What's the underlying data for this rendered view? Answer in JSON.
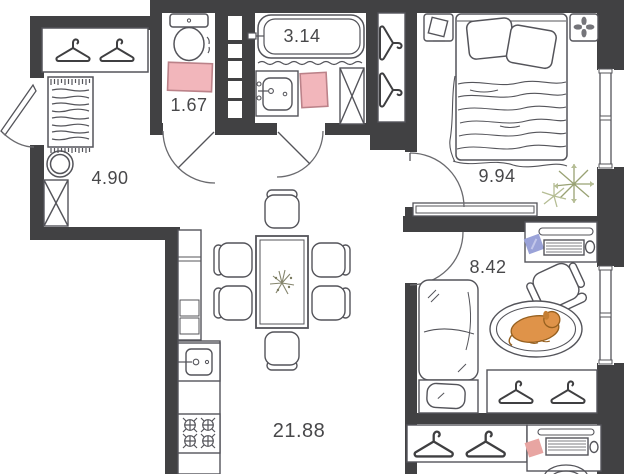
{
  "plan": {
    "title": "apartment-floor-plan",
    "rooms": [
      {
        "id": "hallway",
        "area": "4.90"
      },
      {
        "id": "wc",
        "area": "1.67"
      },
      {
        "id": "bathroom",
        "area": "3.14"
      },
      {
        "id": "bedroom",
        "area": "9.94"
      },
      {
        "id": "office",
        "area": "8.42"
      },
      {
        "id": "kitchen-living",
        "area": "21.88"
      }
    ],
    "colors": {
      "wall": "#414143",
      "line": "#54545a",
      "mat_pink": "#f2b6bb",
      "mat_pink_border": "#bb8289",
      "dog_orange": "#df9349",
      "dog_outline": "#96601f",
      "plant_green": "#99a274",
      "plant_green_light": "#b5bd94",
      "sticky_blue": "#9aa2d8",
      "sticky_pink": "#e8a5a2"
    }
  }
}
